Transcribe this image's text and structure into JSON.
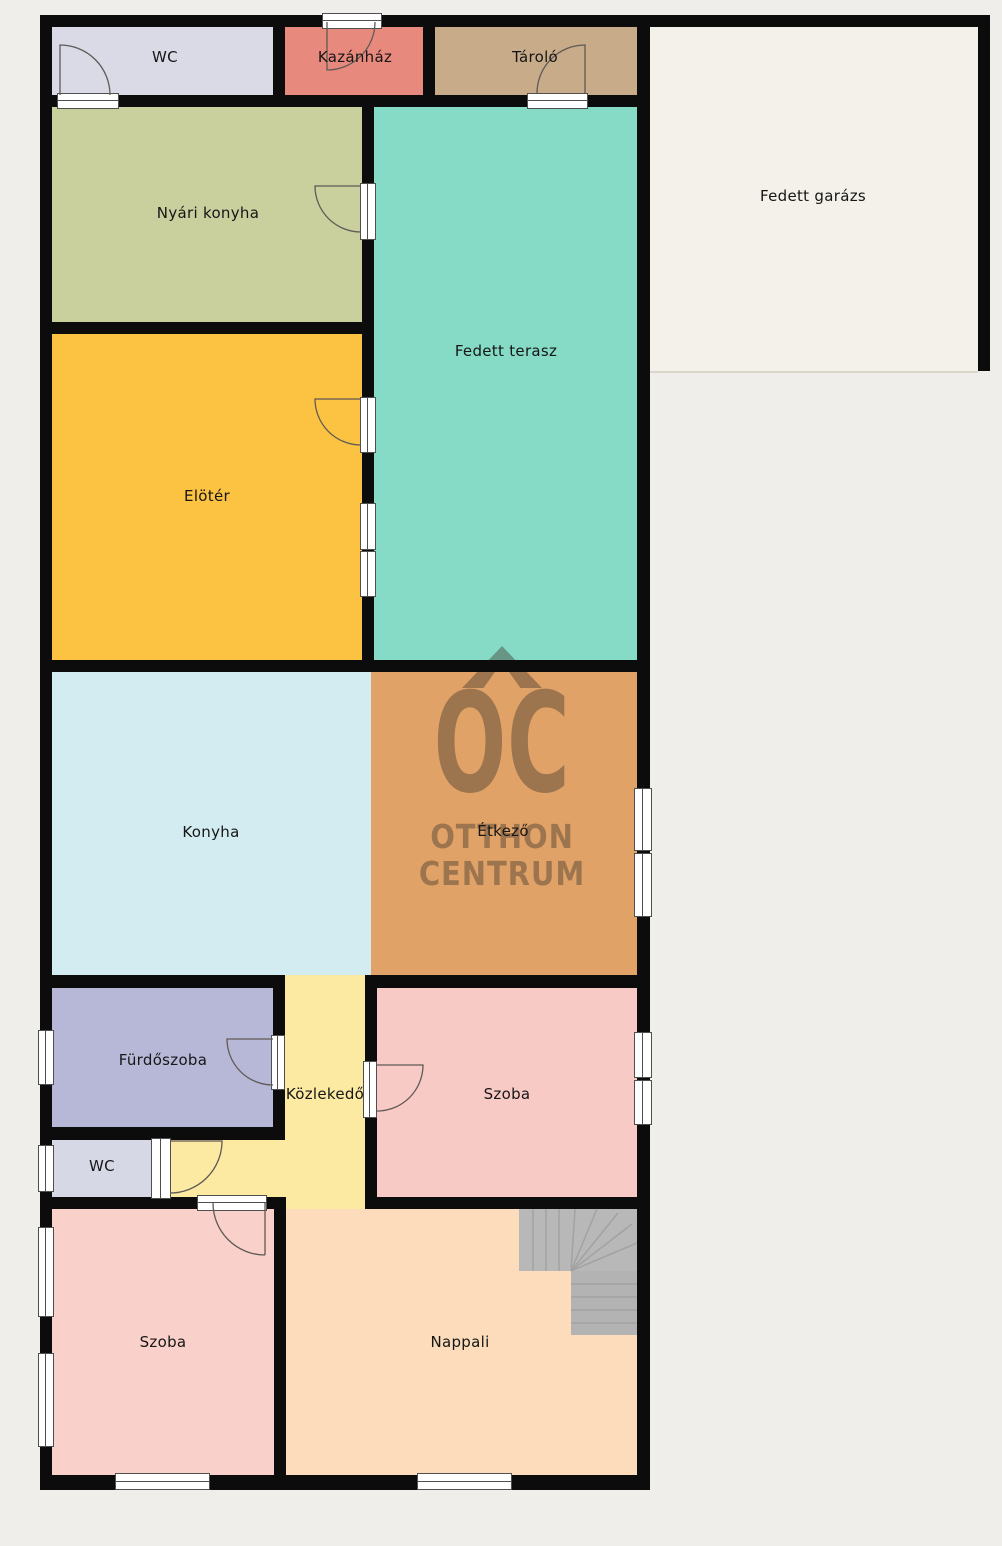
{
  "canvas": {
    "background": "#efeeea",
    "wall_color": "#0c0c0c",
    "stairs_color": "#b7b7b7",
    "garage_fill": "#f3f1e9"
  },
  "rooms": {
    "wc_top": {
      "label": "WC",
      "color": "#dadae7"
    },
    "kazanhaz": {
      "label": "Kazánház",
      "color": "#e8897d"
    },
    "tarolo": {
      "label": "Tároló",
      "color": "#c8ab89"
    },
    "garage": {
      "label": "Fedett garázs",
      "color": "#f3f1e9"
    },
    "nyari_konyha": {
      "label": "Nyári konyha",
      "color": "#c9cf9d"
    },
    "terasz": {
      "label": "Fedett terasz",
      "color": "#86dbc7"
    },
    "eloter": {
      "label": "Elötér",
      "color": "#fcc242"
    },
    "konyha": {
      "label": "Konyha",
      "color": "#d3ecf1"
    },
    "etkezo": {
      "label": "Étkező",
      "color": "#e1a267"
    },
    "furdoszoba": {
      "label": "Fürdőszoba",
      "color": "#b7b8d8"
    },
    "kozlekedo": {
      "label": "Közlekedő",
      "color": "#fce9a2"
    },
    "szoba_kozep": {
      "label": "Szoba",
      "color": "#f8cac5"
    },
    "wc_also": {
      "label": "WC",
      "color": "#d7d8e5"
    },
    "szoba_also": {
      "label": "Szoba",
      "color": "#fad0ca"
    },
    "nappali": {
      "label": "Nappali",
      "color": "#fcdcba"
    }
  },
  "watermark": {
    "monogram": "OC",
    "line1": "OTTHON",
    "line2": "CENTRUM",
    "color": "rgba(62,54,46,0.42)"
  }
}
